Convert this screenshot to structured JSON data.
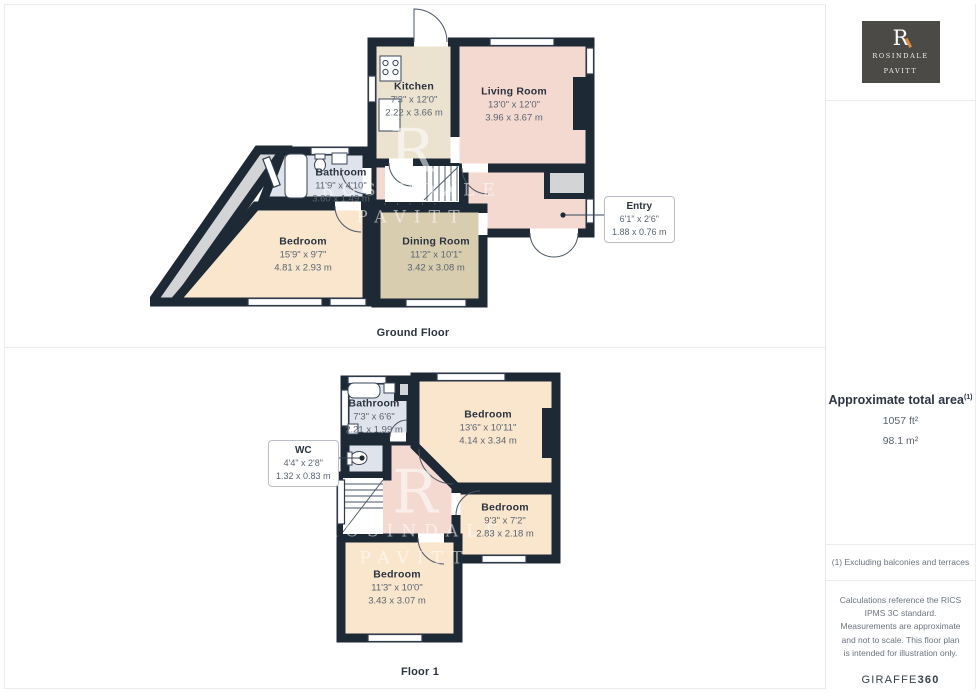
{
  "branding": {
    "r": "R",
    "name1": "ROSINDALE",
    "name2": "PAVITT",
    "dots": "· · · · ·"
  },
  "sidebar": {
    "area_title": "Approximate total area",
    "area_superscript": "(1)",
    "area_ft": "1057 ft²",
    "area_m": "98.1 m²",
    "note1": "(1) Excluding balconies and terraces",
    "note2": "Calculations reference the RICS IPMS 3C standard. Measurements are approximate and not to scale. This floor plan is intended for illustration only.",
    "brand_normal": "GIRAFFE",
    "brand_bold": "360"
  },
  "floors": [
    {
      "label": "Ground Floor",
      "rooms": [
        {
          "name": "Kitchen",
          "imperial": "7'3\" x 12'0\"",
          "metric": "2.22 x 3.66 m"
        },
        {
          "name": "Living Room",
          "imperial": "13'0\" x 12'0\"",
          "metric": "3.96 x 3.67 m"
        },
        {
          "name": "Bathroom",
          "imperial": "11'9\" x 4'10\"",
          "metric": "3.60 x 1.49 m"
        },
        {
          "name": "Bedroom",
          "imperial": "15'9\" x 9'7\"",
          "metric": "4.81 x 2.93 m"
        },
        {
          "name": "Dining Room",
          "imperial": "11'2\" x 10'1\"",
          "metric": "3.42 x 3.08 m"
        },
        {
          "name": "Entry",
          "imperial": "6'1\" x 2'6\"",
          "metric": "1.88 x 0.76 m"
        }
      ]
    },
    {
      "label": "Floor 1",
      "rooms": [
        {
          "name": "Bathroom",
          "imperial": "7'3\" x 6'6\"",
          "metric": "2.21 x 1.99 m"
        },
        {
          "name": "Bedroom",
          "imperial": "13'6\" x 10'11\"",
          "metric": "4.14 x 3.34 m"
        },
        {
          "name": "WC",
          "imperial": "4'4\" x 2'8\"",
          "metric": "1.32 x 0.83 m"
        },
        {
          "name": "Bedroom",
          "imperial": "9'3\" x 7'2\"",
          "metric": "2.83 x 2.18 m"
        },
        {
          "name": "Bedroom",
          "imperial": "11'3\" x 10'0\"",
          "metric": "3.43 x 3.07 m"
        }
      ]
    }
  ],
  "colors": {
    "wall": "#1e2936",
    "pink": "#f4d9d1",
    "cream": "#ebe3cf",
    "tan": "#d9cdb0",
    "peach": "#f9e6cd",
    "blue": "#dfe3ec",
    "gray": "#d3d4d6",
    "white": "#ffffff",
    "logo_bg": "#4b4a47",
    "logo_accent": "#d98a3d"
  }
}
